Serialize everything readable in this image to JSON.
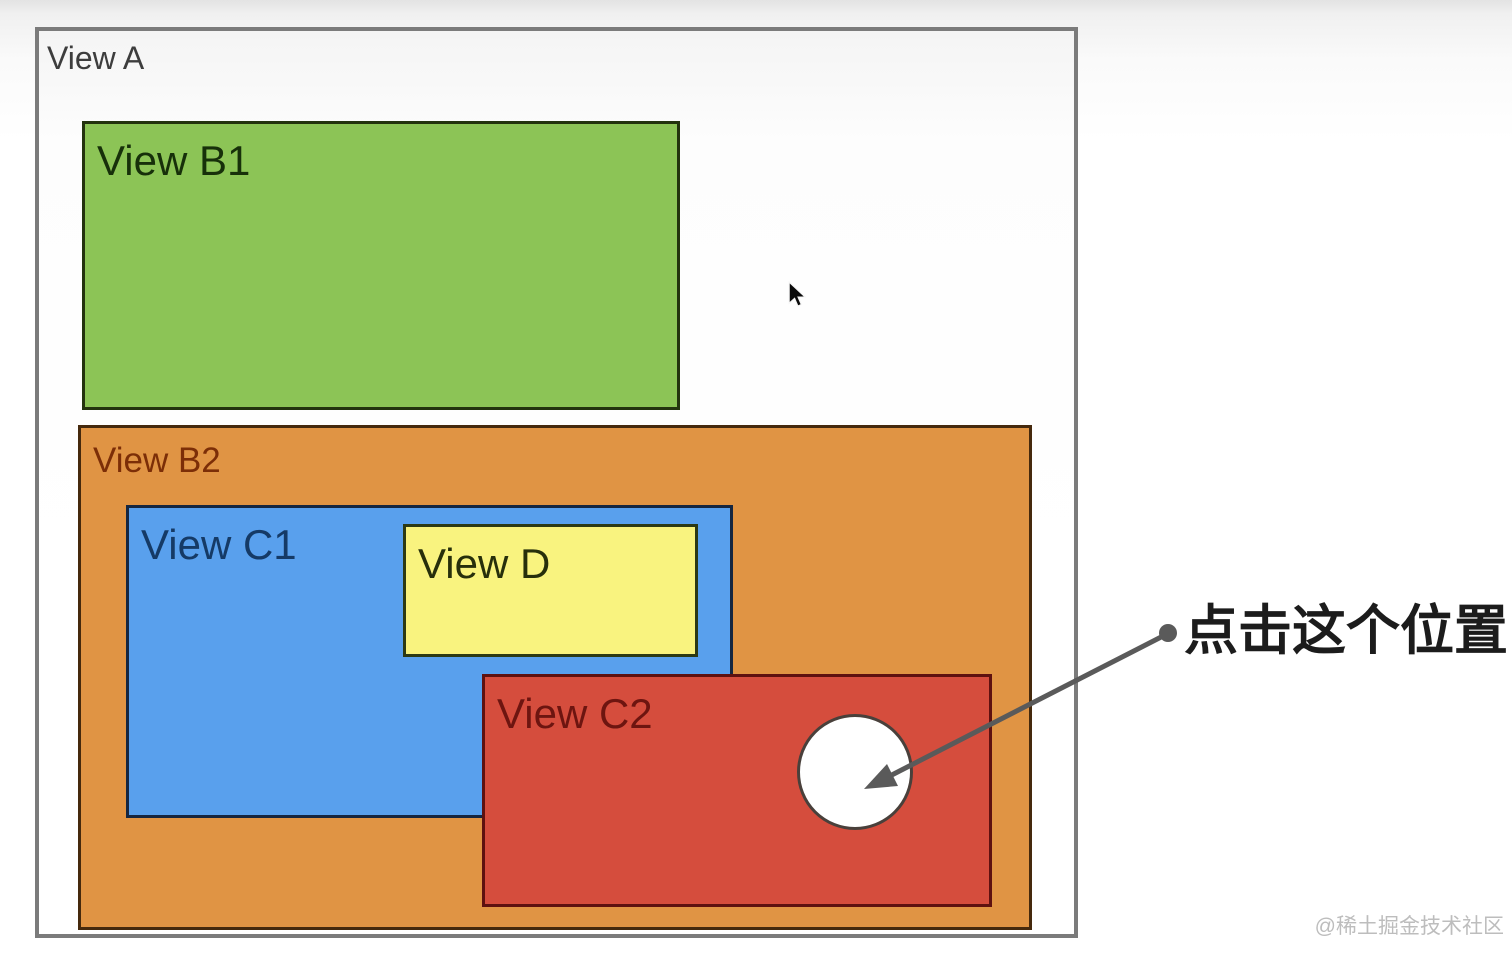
{
  "views": {
    "a": {
      "label": "View A",
      "fill": "#fdfdfd",
      "border_color": "#7b7b7b",
      "label_color": "#3d3d3d"
    },
    "b1": {
      "label": "View B1",
      "fill": "#8cc456",
      "border_color": "#23330e",
      "label_color": "#17300a"
    },
    "b2": {
      "label": "View B2",
      "fill": "#e09444",
      "border_color": "#45290d",
      "label_color": "#7c2e07"
    },
    "c1": {
      "label": "View C1",
      "fill": "#59a0ed",
      "border_color": "#152640",
      "label_color": "#153a66"
    },
    "d": {
      "label": "View D",
      "fill": "#f9f37f",
      "border_color": "#2c3914",
      "label_color": "#272f0b"
    },
    "c2": {
      "label": "View C2",
      "fill": "#d54d3d",
      "border_color": "#5e1110",
      "label_color": "#6d1510"
    }
  },
  "tap_target": {
    "shape": "circle",
    "fill": "#ffffff",
    "border_color": "#49403b"
  },
  "annotation": {
    "text": "点击这个位置",
    "arrow_color": "#5a5a5a",
    "text_color": "#1c1c1c"
  },
  "watermark": {
    "text": "@稀土掘金技术社区",
    "color": "#bdbdbd"
  },
  "cursor": {
    "type": "arrow-pointer",
    "color": "#0a0a0a"
  }
}
